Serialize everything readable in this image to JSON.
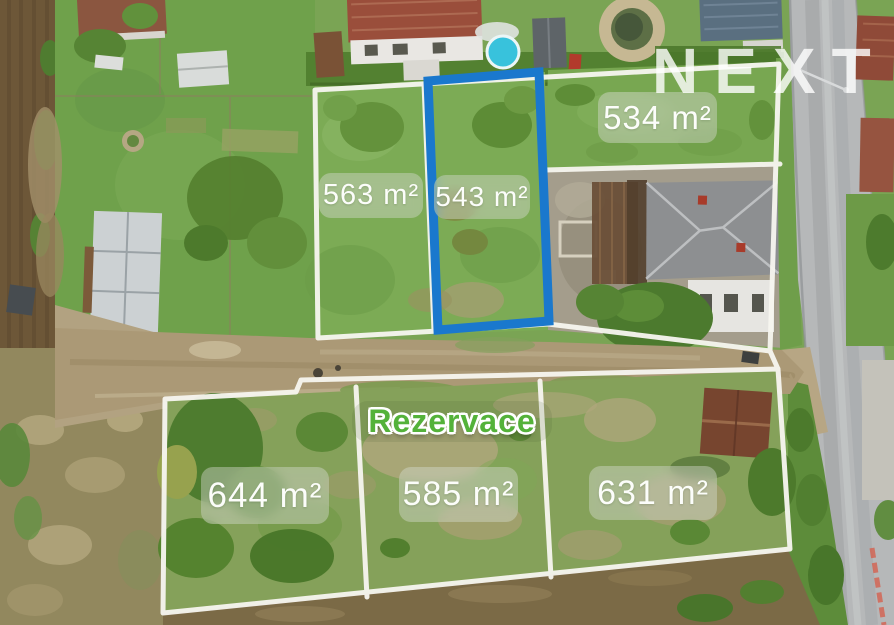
{
  "overlay": {
    "brand": "NEXT",
    "reservation": "Rezervace"
  },
  "plots": {
    "p563": {
      "label": "563 m²",
      "highlighted": false
    },
    "p543": {
      "label": "543 m²",
      "highlighted": true
    },
    "p534": {
      "label": "534 m²",
      "highlighted": false
    },
    "p644": {
      "label": "644 m²",
      "highlighted": false
    },
    "p585": {
      "label": "585 m²",
      "highlighted": false
    },
    "p631": {
      "label": "631 m²",
      "highlighted": false
    }
  },
  "colors": {
    "boundary_white": "#f7f6f0",
    "highlight_blue": "#1a78cd",
    "reservation_green": "#54b23a"
  }
}
